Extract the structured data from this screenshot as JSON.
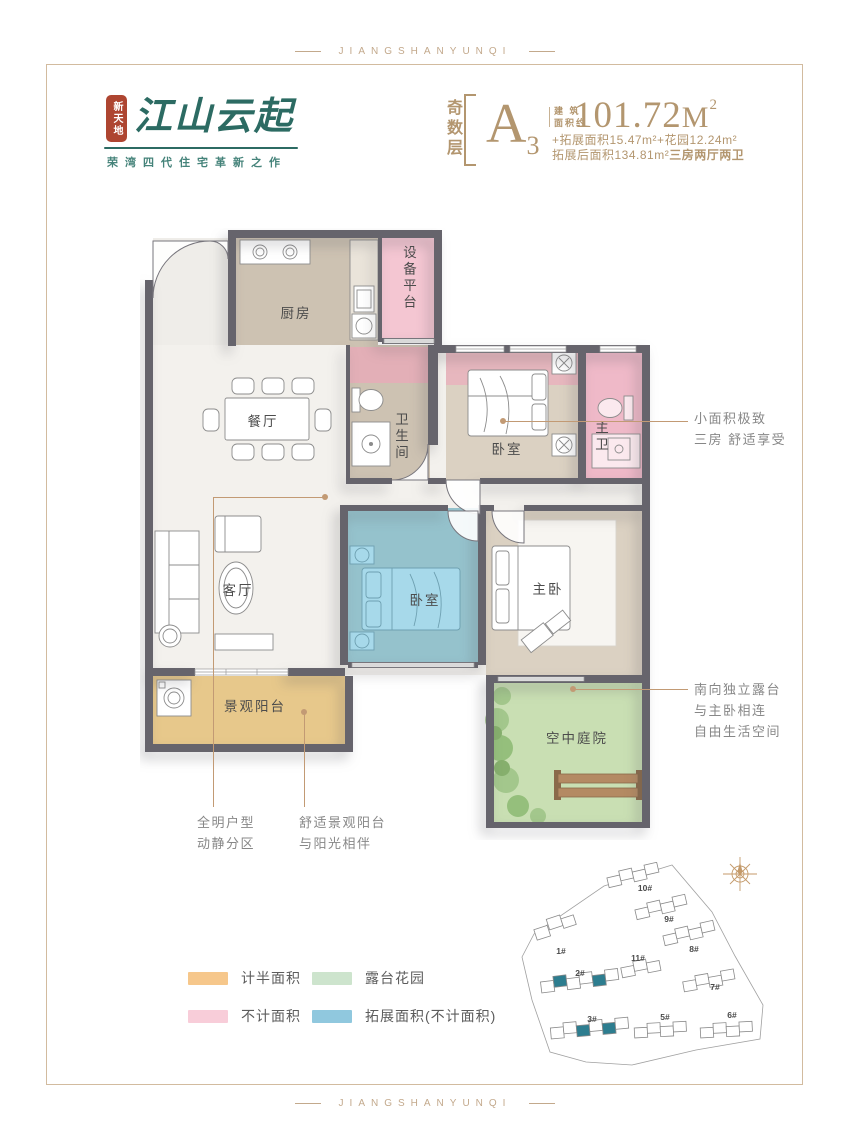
{
  "page": {
    "border_label": "JIANGSHANYUNQI"
  },
  "brand": {
    "seal_text": "新天地",
    "name": "江山云起",
    "tagline": "荣湾四代住宅革新之作"
  },
  "spec": {
    "floor_tag": "奇数层",
    "unit_letter": "A",
    "unit_number": "3",
    "area_label_1": "建 筑",
    "area_label_2": "面积约",
    "area_value": "101.72",
    "area_unit": "M",
    "area_superscript": "2",
    "detail_line_1": "+拓展面积15.47m²+花园12.24m²",
    "detail_line_2": "拓展后面积134.81m²",
    "detail_line_2_bold": "三房两厅两卫"
  },
  "rooms": {
    "kitchen": "厨房",
    "equipment_platform": "设备平台",
    "dining": "餐厅",
    "bathroom": "卫生间",
    "bedroom_top": "卧室",
    "master_bathroom": "主卫",
    "living": "客厅",
    "bedroom_extension": "卧室",
    "master_bedroom": "主卧",
    "balcony": "景观阳台",
    "courtyard": "空中庭院"
  },
  "annotations": {
    "right_top": [
      "小面积极致",
      "三房 舒适享受"
    ],
    "right_bottom": [
      "南向独立露台",
      "与主卧相连",
      "自由生活空间"
    ],
    "bottom_left_1": [
      "全明户型",
      "动静分区"
    ],
    "bottom_left_2": [
      "舒适景观阳台",
      "与阳光相伴"
    ]
  },
  "legend": {
    "items": [
      {
        "label": "计半面积",
        "color": "#f6c78b"
      },
      {
        "label": "露台花园",
        "color": "#cde4cd"
      },
      {
        "label": "不计面积",
        "color": "#f8cdd9"
      },
      {
        "label": "拓展面积(不计面积)",
        "color": "#90c8de"
      }
    ]
  },
  "siteplan": {
    "buildings": [
      {
        "label": "1#"
      },
      {
        "label": "2#"
      },
      {
        "label": "3#"
      },
      {
        "label": "5#"
      },
      {
        "label": "6#"
      },
      {
        "label": "7#"
      },
      {
        "label": "8#"
      },
      {
        "label": "9#"
      },
      {
        "label": "10#"
      },
      {
        "label": "11#"
      }
    ],
    "highlight_color": "#2d7d8f"
  },
  "colors": {
    "brand_tan": "#b3966f",
    "logo_teal": "#2c6b63",
    "seal_red": "#ae4531",
    "wall": "#66646c",
    "pink": "#f0bcca",
    "blue_overlay": "#50b4d6",
    "balcony": "#e7c88b",
    "courtyard": "#c9dfb3"
  }
}
